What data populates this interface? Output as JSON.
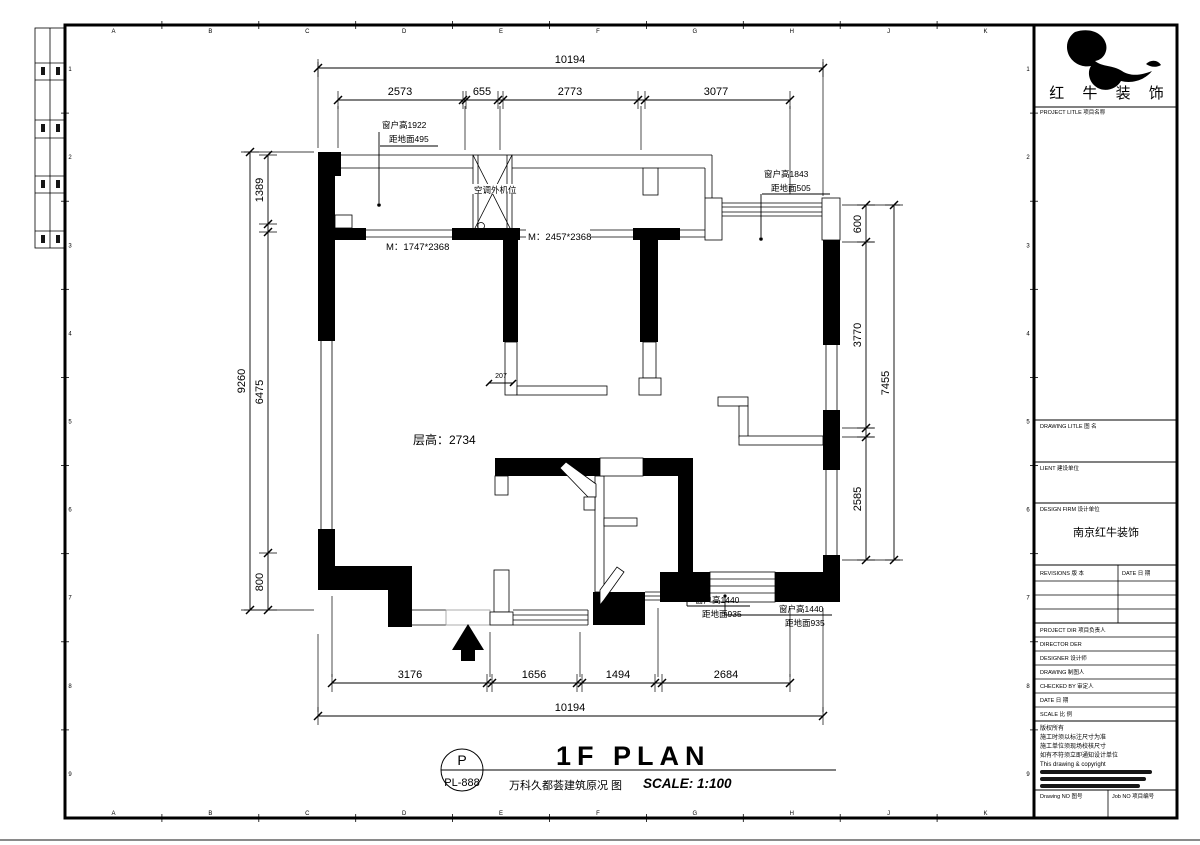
{
  "grid": {
    "letters": [
      "A",
      "B",
      "C",
      "D",
      "E",
      "F",
      "G",
      "H",
      "J",
      "K"
    ],
    "numbers": [
      "1",
      "2",
      "3",
      "4",
      "5",
      "6",
      "7",
      "8",
      "9"
    ]
  },
  "dims": {
    "top": {
      "overall": "10194",
      "seg": [
        "2573",
        "655",
        "2773",
        "3077"
      ]
    },
    "bottom": {
      "overall": "10194",
      "seg": [
        "3176",
        "1656",
        "1494",
        "2684"
      ]
    },
    "left": {
      "overall": "9260",
      "seg": [
        "1389",
        "6475",
        "800"
      ]
    },
    "right": {
      "overall": "7455",
      "seg": [
        "600",
        "3770",
        "2585"
      ]
    },
    "small": "207"
  },
  "plan": {
    "ac_unit": "空调外机位",
    "door_left": "M：1747*2368",
    "door_mid": "M：2457*2368",
    "ceiling": "层高：2734",
    "win_top_left": {
      "l1": "窗户高1922",
      "l2": "距地面495"
    },
    "win_top_right": {
      "l1": "窗户高1843",
      "l2": "距地面505"
    },
    "win_bottom_mid": {
      "l1": "窗户高1440",
      "l2": "距地面935"
    },
    "win_bottom_right": {
      "l1": "窗户高1440",
      "l2": "距地面935"
    }
  },
  "footer": {
    "code_letter": "P",
    "code": "PL-888",
    "title": "1F PLAN",
    "subtitle": "万科久都荟建筑原况 图",
    "scale": "SCALE: 1:100"
  },
  "titleblock": {
    "company": "红 牛 装 饰",
    "project_title": "PROJECT LITLE 项目名称",
    "drawing_title": "DRAWING LITLE 图 名",
    "client": "LIENT 建设单位",
    "design_firm": "DESIGN FIRM 设计单位",
    "design_firm_value": "南京红牛装饰",
    "revisions": "REVISIONS 版 本",
    "date_col": "DATE 日 期",
    "project_dir": "PROJECT DIR 项目负责人",
    "director": "DIRECTOR DER",
    "designer": "DESIGNER 设计师",
    "drawing": "DRAWING 制图人",
    "checked": "CHECKED BY 审定人",
    "date": "DATE 日 期",
    "scale": "SCALE 比 例",
    "notes": [
      "版权所有",
      "施工时须以标注尺寸为准",
      "施工单位须现场校核尺寸",
      "如有不符须立即通知设计单位",
      "This drawing & copyright"
    ],
    "drawing_no": "Drawing NO 图号",
    "job_no": "Job NO 项目编号"
  }
}
